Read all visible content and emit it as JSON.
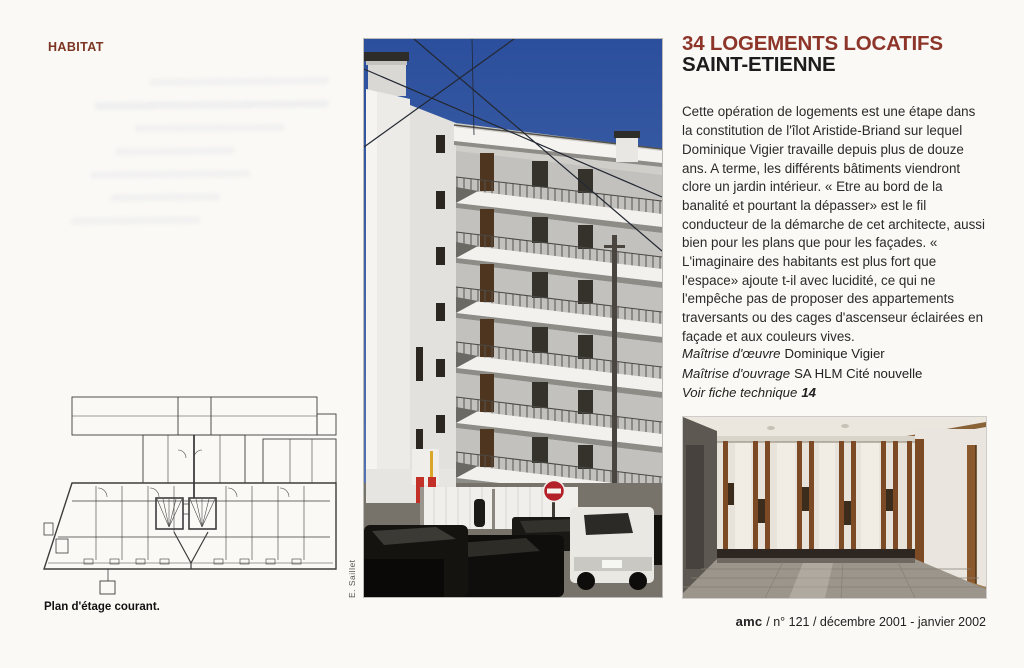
{
  "page": {
    "section_label": "HABITAT",
    "article": {
      "title_line1": "34 LOGEMENTS LOCATIFS",
      "title_line2": "SAINT-ETIENNE",
      "body": "Cette opération de logements est une étape dans la constitution de l'îlot Aristide-Briand sur lequel Dominique Vigier travaille depuis plus de douze ans. A terme, les différents bâtiments viendront clore un jardin intérieur. « Etre au bord de la banalité et pourtant la dépasser» est le fil conducteur de la démarche de cet architecte, aussi bien pour les plans que pour les façades. « L'imaginaire des habitants est plus fort que l'espace» ajoute t-il avec lucidité, ce qui ne l'empêche pas de proposer des appartements traversants ou des cages d'ascenseur éclairées en façade et aux couleurs vives."
    },
    "credits": [
      {
        "label": "Maîtrise d'œuvre",
        "value": "Dominique Vigier"
      },
      {
        "label": "Maîtrise d'ouvrage",
        "value": "SA HLM Cité nouvelle"
      },
      {
        "label": "Voir fiche technique",
        "value": "14"
      }
    ],
    "plan_caption": "Plan d'étage courant.",
    "photo_credit": "E. Saillet",
    "footer": {
      "magazine": "amc",
      "issue_info": "/ n° 121 / décembre 2001 - janvier 2002"
    },
    "colors": {
      "accent_red": "#8e352a",
      "section_red": "#7c3522",
      "sky_blue": "#3a5ca3",
      "text": "#222222"
    }
  }
}
